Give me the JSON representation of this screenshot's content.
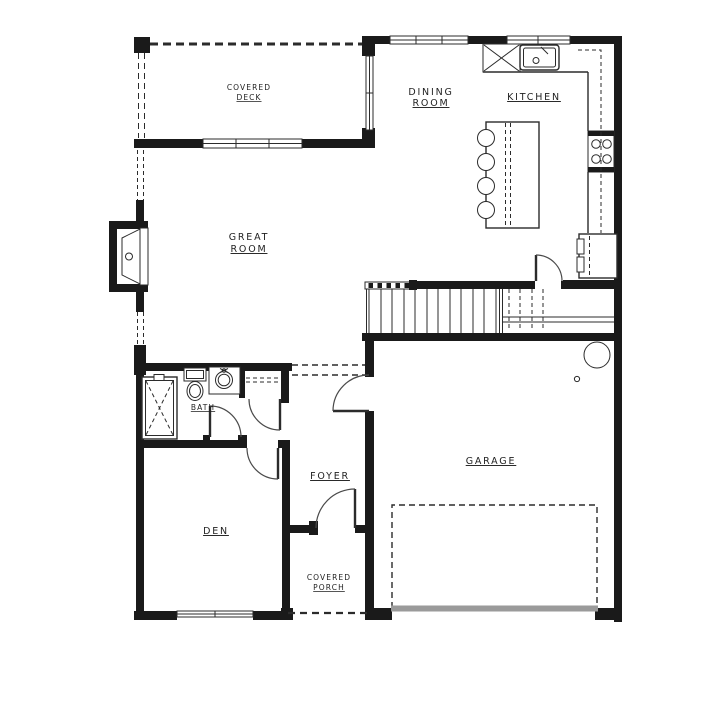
{
  "drawing": {
    "type": "residential-first-floor-plan",
    "labels": {
      "covered_deck": {
        "line1": "COVERED",
        "line2": "DECK"
      },
      "dining_room": {
        "line1": "DINING",
        "line2": "ROOM"
      },
      "kitchen": {
        "text": "KITCHEN"
      },
      "great_room": {
        "line1": "GREAT",
        "line2": "ROOM"
      },
      "bath": {
        "text": "BATH"
      },
      "foyer": {
        "text": "FOYER"
      },
      "den": {
        "text": "DEN"
      },
      "covered_porch": {
        "line1": "COVERED",
        "line2": "PORCH"
      },
      "garage": {
        "text": "GARAGE"
      }
    },
    "colors": {
      "wall": "#1a1a1a",
      "line": "#2b2b2b",
      "garage_door": "#9a9a9a",
      "background": "#ffffff"
    }
  }
}
